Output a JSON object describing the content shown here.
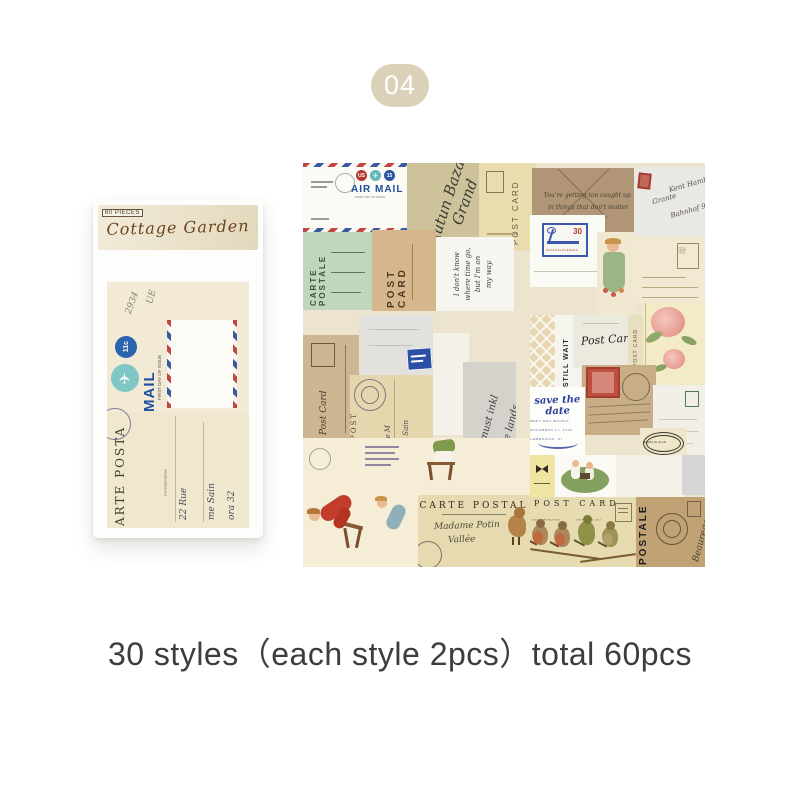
{
  "badge": {
    "label": "04"
  },
  "colors": {
    "badge_bg": "#dbd1b9",
    "caption_text": "#3d3d3d",
    "airmail_blue": "#2b55a0",
    "airmail_red": "#b5372e",
    "kraft": "#b09676"
  },
  "icons": {
    "airplane": "✈"
  },
  "package": {
    "pieces_tag": "60 PIECES",
    "title": "Cottage Garden",
    "print": {
      "note1": "2934",
      "note2": "UE",
      "postage_value": "11c",
      "mail": "MAIL",
      "first_day": "FIRST DAY OF ISSUE",
      "carte_vertical": "ARTE POSTA",
      "correspondance": "Correspondance",
      "script1": "22 Rue",
      "script2": "me Sain",
      "script3": "ora 32"
    }
  },
  "collage": {
    "airmail": {
      "us": "US",
      "value": "15",
      "title": "AIR MAIL",
      "first_day": "FIRST DAY OF ISSUE"
    },
    "olive": {
      "script1": "Autun Bazal",
      "script2": "Grand"
    },
    "cream_postcard": {
      "label": "POST CARD"
    },
    "kraft": {
      "line1": "You're getting too caught up",
      "line2": "in things that don't matter"
    },
    "white_envelope": {
      "script1": "Grante",
      "script2": "Kent Hamburg",
      "script3": "Bahnhof 9"
    },
    "green_carte": {
      "label": "CARTE POSTALE"
    },
    "tan_postcard": {
      "label": "POST CARD"
    },
    "note": {
      "line1": "I don't know",
      "line2": "where time go,",
      "line3": "but I'm on",
      "line4": "my way."
    },
    "stamp_card": {
      "value": "30",
      "country": "ČESKOSLOVENSKO"
    },
    "lines_postcard": {
      "stamp_box": "PLACE STAMP HERE"
    },
    "tan_postcard2": {
      "label": "Post Card"
    },
    "aged_carte": {
      "vertical": "RTE POST",
      "script1": "Madelle M",
      "script2": "11 Rue Sain",
      "script3": "ora 32"
    },
    "gray_script": {
      "line1": "It must inkl",
      "line2": "the lands"
    },
    "still_wait": {
      "label": "I STILL WAIT"
    },
    "script_postcard": {
      "label": "Post Card"
    },
    "strip_postcard": {
      "label": "POST CARD"
    },
    "save_date": {
      "title": "save the date",
      "line1": "MARY AND WILDER",
      "line2": "NOVEMBER 17, 2015",
      "line3": "CAMBRIDGE, RI"
    },
    "arlatte": {
      "label": "ARLATTE & Co"
    },
    "carte_postal": {
      "title": "CARTE POSTAL",
      "script1": "Madame Potin",
      "script2": "Vallée"
    },
    "birds": {
      "title": "POST CARD",
      "left_note": "FOR COMMUNICATION",
      "right_note": "THE ADDRESS ONLY"
    },
    "postale": {
      "label": "POSTALE",
      "script": "Beauregard"
    }
  },
  "caption": {
    "text": "30 styles（each style 2pcs）total 60pcs"
  }
}
